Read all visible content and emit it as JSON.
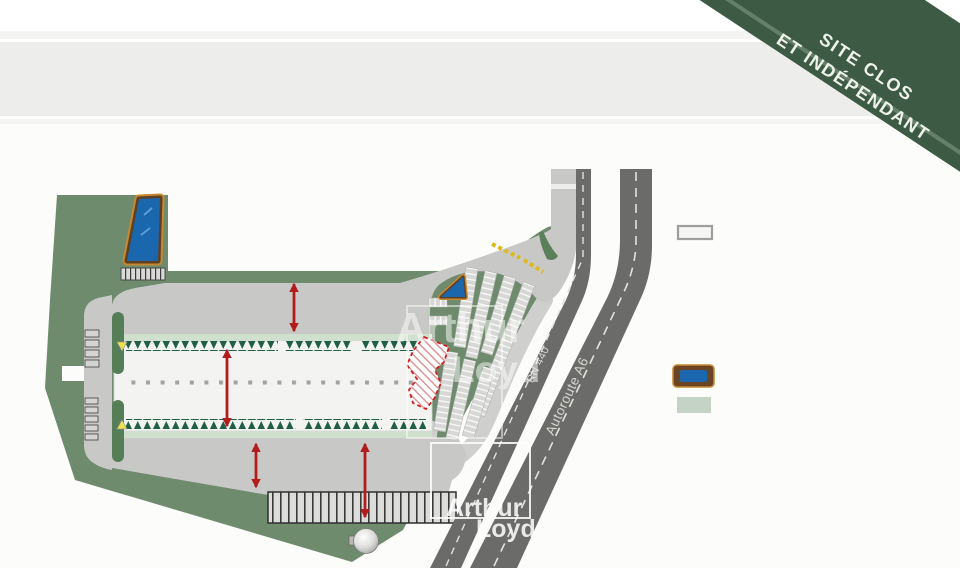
{
  "banner": {
    "line1": "SITE CLOS",
    "line2": "ET INDÉPENDANT"
  },
  "roads": {
    "rn440": "RN 440",
    "a6": "Autoroute A6"
  },
  "watermark": {
    "line1": "Arthur",
    "line2": "Loyd"
  },
  "legend": [
    {
      "fill": "#f5f5f3",
      "border": "#9e9e9c"
    },
    {
      "fill": "#1a67ae",
      "border": "#6b4423"
    },
    {
      "fill": "#c4d3c6",
      "border": ""
    }
  ],
  "colors": {
    "banner_green": "#3d5a44",
    "site_green": "#6f8b6e",
    "road_gray": "#6b6b69",
    "apron_gray": "#c8c8c6",
    "building_fill": "#f3f4f1",
    "building_edge": "#cfe0cf",
    "tree_green": "#215f45",
    "basin_blue": "#1a67ae",
    "basin_border": "#6b4423",
    "dimension_red": "#b11d1d",
    "gate_yellow": "#ddb91e",
    "hatch_red": "#cc2222"
  }
}
